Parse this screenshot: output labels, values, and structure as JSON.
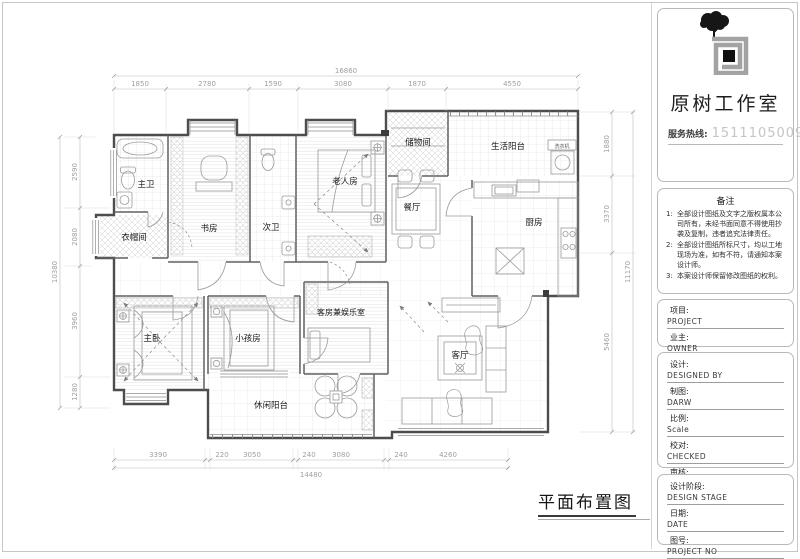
{
  "studio": {
    "name": "原树工作室",
    "hotline_label": "服务热线:",
    "hotline_number": "15111050095"
  },
  "notes": {
    "title": "备注",
    "items": [
      {
        "num": "1:",
        "text": "全部设计图纸及文字之版权属本公司所有，未经书面同意不得使用抄袭及复制，违者追究法律责任。"
      },
      {
        "num": "2:",
        "text": "全部设计图纸所标尺寸，均以工地现场为准，如有不符，请通知本案设计师。"
      },
      {
        "num": "3:",
        "text": "本案设计师保留修改图纸的权利。"
      }
    ]
  },
  "info": {
    "fields": [
      {
        "label": "项目:",
        "value": "PROJECT"
      },
      {
        "label": "业主:",
        "value": "OWNER"
      }
    ]
  },
  "design": {
    "fields": [
      {
        "label": "设计:",
        "value": "DESIGNED BY"
      },
      {
        "label": "制图:",
        "value": "DARW"
      },
      {
        "label": "比例:",
        "value": "Scale"
      },
      {
        "label": "校对:",
        "value": "CHECKED"
      },
      {
        "label": "审核:",
        "value": "APPROVED BY"
      }
    ]
  },
  "stage": {
    "fields": [
      {
        "label": "设计阶段:",
        "value": "DESIGN STAGE"
      },
      {
        "label": "日期:",
        "value": "DATE"
      },
      {
        "label": "图号:",
        "value": "PROJECT NO"
      }
    ]
  },
  "plan": {
    "title": "平面布置图",
    "rooms": {
      "master_bath": "主卫",
      "cloakroom": "衣帽间",
      "study": "书房",
      "second_bath": "次卫",
      "elder_room": "老人房",
      "storage": "储物间",
      "service_balcony": "生活阳台",
      "washer": "洗衣机",
      "dining": "餐厅",
      "kitchen": "厨房",
      "master_bedroom": "主卧",
      "kids_room": "小孩房",
      "guest_room": "客房兼娱乐室",
      "living_room": "客厅",
      "leisure_balcony": "休闲阳台"
    },
    "dims": {
      "top_total": "16860",
      "top": [
        "1850",
        "2780",
        "1590",
        "3080",
        "1870",
        "4550"
      ],
      "bottom": [
        "3390",
        "220",
        "3050",
        "240",
        "3080",
        "240",
        "4260"
      ],
      "bottom_total": "14480",
      "left": [
        "2590",
        "2080",
        "3960",
        "1280"
      ],
      "left_total": "10380",
      "right": [
        "1880",
        "3370",
        "5460"
      ],
      "right_total": "11170"
    }
  }
}
